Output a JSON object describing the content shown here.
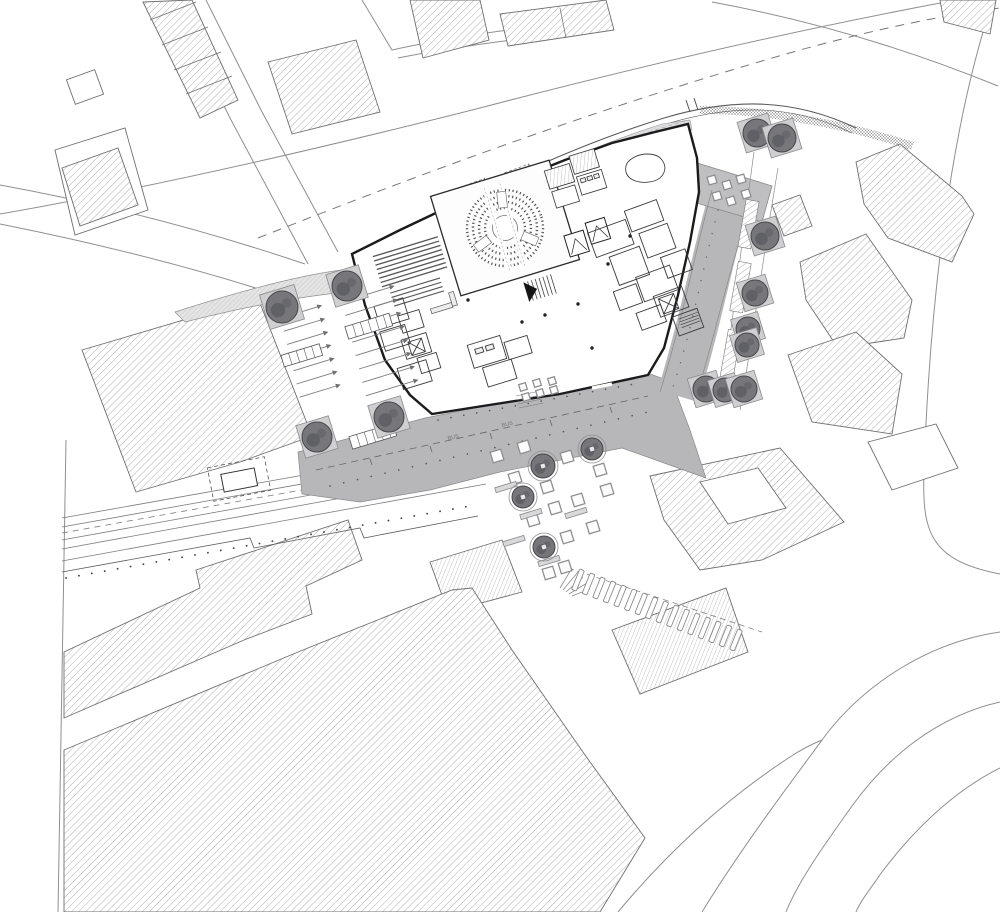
{
  "meta": {
    "drawing_type": "architectural site plan / ground floor plan",
    "view": "top-down plan",
    "visible_text": "tiny BUS lane markings only"
  },
  "palette": {
    "paper": "#ffffff",
    "context_line": "#8f8f90",
    "hatch_line": "#a6a6a9",
    "wall": "#1b1b1d",
    "interior_line": "#3a3a3d",
    "canopy_fill": "#dcdcde",
    "sidewalk_fill": "#e4e4e5",
    "plaza_fill": "#b7b7b9",
    "terrace_fill": "#bfbfc1",
    "tree_fill": "#76767b",
    "tree_outline": "#46464b",
    "tree_blob": "#5a5a60",
    "planter_fill": "#cfcfd1",
    "table_stroke": "#8f8f92",
    "seat_line": "#555558"
  },
  "labels": {
    "bus": [
      "BUS",
      "BUS"
    ]
  },
  "site": {
    "building": "new public building with circular auditorium, raked lecture hall, foyer, cores and service wing",
    "context": "hatched existing city blocks, curving streets, rail corridor with platform, gray pedestrian plaza, elevated walkway, street trees, outdoor tables, zebra crossing"
  },
  "trees": [
    {
      "x": 282,
      "y": 307,
      "r": 16,
      "planter": true
    },
    {
      "x": 347,
      "y": 286,
      "r": 15,
      "planter": true
    },
    {
      "x": 317,
      "y": 437,
      "r": 15,
      "planter": true
    },
    {
      "x": 389,
      "y": 417,
      "r": 15,
      "planter": true
    },
    {
      "x": 757,
      "y": 133,
      "r": 14,
      "planter": true
    },
    {
      "x": 782,
      "y": 138,
      "r": 14,
      "planter": true
    },
    {
      "x": 765,
      "y": 236,
      "r": 14,
      "planter": true
    },
    {
      "x": 755,
      "y": 293,
      "r": 13,
      "planter": true
    },
    {
      "x": 748,
      "y": 329,
      "r": 12,
      "planter": true
    },
    {
      "x": 747,
      "y": 345,
      "r": 12,
      "planter": true
    },
    {
      "x": 706,
      "y": 389,
      "r": 13,
      "planter": true
    },
    {
      "x": 725,
      "y": 390,
      "r": 12,
      "planter": true
    },
    {
      "x": 744,
      "y": 389,
      "r": 13,
      "planter": true
    },
    {
      "x": 543,
      "y": 466,
      "r": 12,
      "ring": true
    },
    {
      "x": 592,
      "y": 449,
      "r": 11,
      "ring": true
    },
    {
      "x": 523,
      "y": 497,
      "r": 11,
      "ring": true
    },
    {
      "x": 544,
      "y": 547,
      "r": 11,
      "ring": true
    }
  ],
  "plaza_tables": [
    [
      515,
      478
    ],
    [
      547,
      487
    ],
    [
      567,
      457
    ],
    [
      600,
      470
    ],
    [
      578,
      500
    ],
    [
      555,
      508
    ],
    [
      533,
      520
    ],
    [
      567,
      537
    ],
    [
      593,
      527
    ],
    [
      607,
      490
    ],
    [
      565,
      567
    ],
    [
      549,
      573
    ],
    [
      524,
      447
    ],
    [
      497,
      456
    ]
  ],
  "cafe_tables": [
    [
      523,
      387
    ],
    [
      537,
      383
    ],
    [
      552,
      381
    ],
    [
      526,
      397
    ],
    [
      540,
      393
    ],
    [
      554,
      390
    ]
  ],
  "terrace_tables": [
    [
      712,
      180
    ],
    [
      727,
      185
    ],
    [
      741,
      179
    ],
    [
      717,
      196
    ],
    [
      731,
      201
    ],
    [
      746,
      194
    ]
  ],
  "benches": [
    [
      506,
      487
    ],
    [
      531,
      514
    ],
    [
      514,
      541
    ],
    [
      549,
      561
    ],
    [
      576,
      513
    ]
  ],
  "parking_rows": [
    {
      "x": 281,
      "y": 318,
      "stepX": 3.1,
      "stepY": 13.2,
      "len": 40,
      "count": 7,
      "tilt": -17
    },
    {
      "x": 342,
      "y": 302,
      "stepX": 3.4,
      "stepY": 13.4,
      "len": 52,
      "count": 8,
      "tilt": -17
    }
  ],
  "crosswalk": {
    "x1": 578,
    "y1": 580,
    "x2": 736,
    "y2": 640,
    "bars": 16,
    "bar_len": 22,
    "bar_w": 5,
    "tilt": 22
  },
  "counts": {
    "trees": 17,
    "plaza_tables": 14,
    "cafe_tables": 6,
    "terrace_tables": 6,
    "benches": 5,
    "parking_stalls": 15,
    "crosswalk_bars": 16
  }
}
